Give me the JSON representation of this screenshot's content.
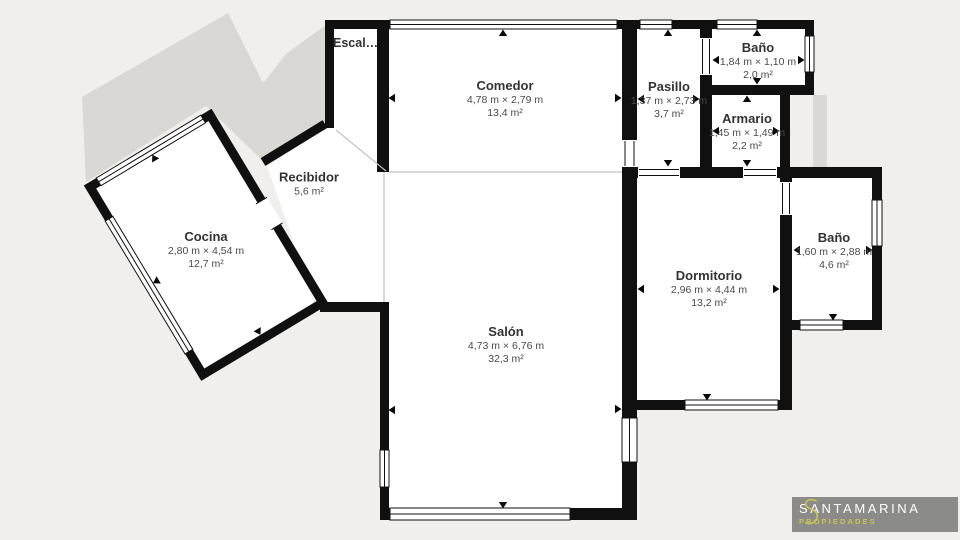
{
  "plan": {
    "title": "floor-plan",
    "colors": {
      "background": "#f0efed",
      "wall": "#101010",
      "room_fill": "#ffffff",
      "shadow": "#d9d8d5",
      "open_boundary_line": "#c2c2c2",
      "room_title_text": "#333333",
      "room_detail_text": "#4a4a4a"
    },
    "rooms": [
      {
        "id": "escalera",
        "name": "Escal…",
        "dims": "",
        "area": ""
      },
      {
        "id": "comedor",
        "name": "Comedor",
        "dims": "4,78 m × 2,79 m",
        "area": "13,4 m²"
      },
      {
        "id": "pasillo",
        "name": "Pasillo",
        "dims": "1,37 m × 2,73 m",
        "area": "3,7 m²"
      },
      {
        "id": "bano_superior",
        "name": "Baño",
        "dims": "1,84 m × 1,10 m",
        "area": "2,0 m²"
      },
      {
        "id": "armario",
        "name": "Armario",
        "dims": "1,45 m × 1,49 m",
        "area": "2,2 m²"
      },
      {
        "id": "recibidor",
        "name": "Recibidor",
        "dims": "",
        "area": "5,6 m²"
      },
      {
        "id": "cocina",
        "name": "Cocina",
        "dims": "2,80 m × 4,54 m",
        "area": "12,7 m²"
      },
      {
        "id": "salon",
        "name": "Salón",
        "dims": "4,73 m × 6,76 m",
        "area": "32,3 m²"
      },
      {
        "id": "dormitorio",
        "name": "Dormitorio",
        "dims": "2,96 m × 4,44 m",
        "area": "13,2 m²"
      },
      {
        "id": "bano_derecho",
        "name": "Baño",
        "dims": "1,60 m × 2,88 m",
        "area": "4,6 m²"
      }
    ],
    "logo": {
      "brand": "SANTAMARINA",
      "tagline": "PROPIEDADES",
      "box_color": "#8b8b89",
      "accent_color": "#c9c553",
      "brand_text_color": "#ffffff"
    }
  }
}
